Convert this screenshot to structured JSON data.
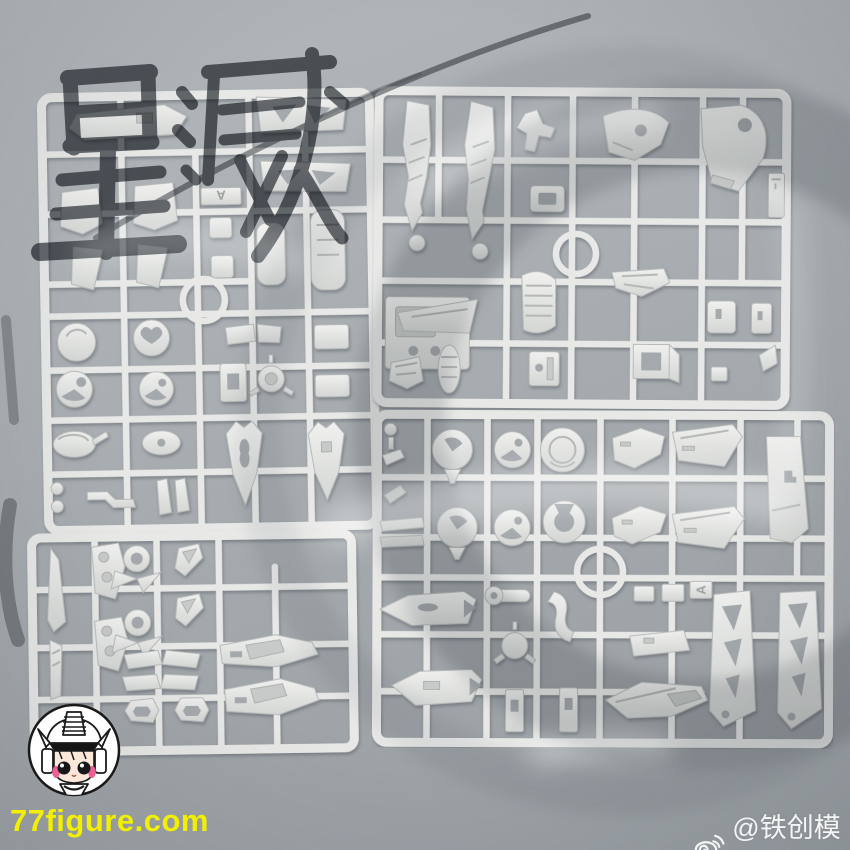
{
  "scene": {
    "description": "Overhead photo of four light-gray injection-molded model kit sprues (part runners) laid on a gray brushed backdrop",
    "background_color": "#a8adb1",
    "plastic_color": "#e8e9e7"
  },
  "watermark": {
    "calligraphy_text": "星灭",
    "calligraphy_color": "#41464c",
    "ring_color": "#565c63"
  },
  "branding": {
    "url": "77figure.com",
    "url_color": "#f3ef00",
    "mascot_icon": "chibi-gundam-helmet-badge"
  },
  "social": {
    "icon": "weibo-icon",
    "handle": "@铁创模型",
    "text_color": "#f4f5f5"
  },
  "sprues": [
    {
      "id": "top-left",
      "tag": "A"
    },
    {
      "id": "top-right",
      "tag": ""
    },
    {
      "id": "bottom-right",
      "tag": "A"
    },
    {
      "id": "bottom-left",
      "tag": ""
    }
  ]
}
